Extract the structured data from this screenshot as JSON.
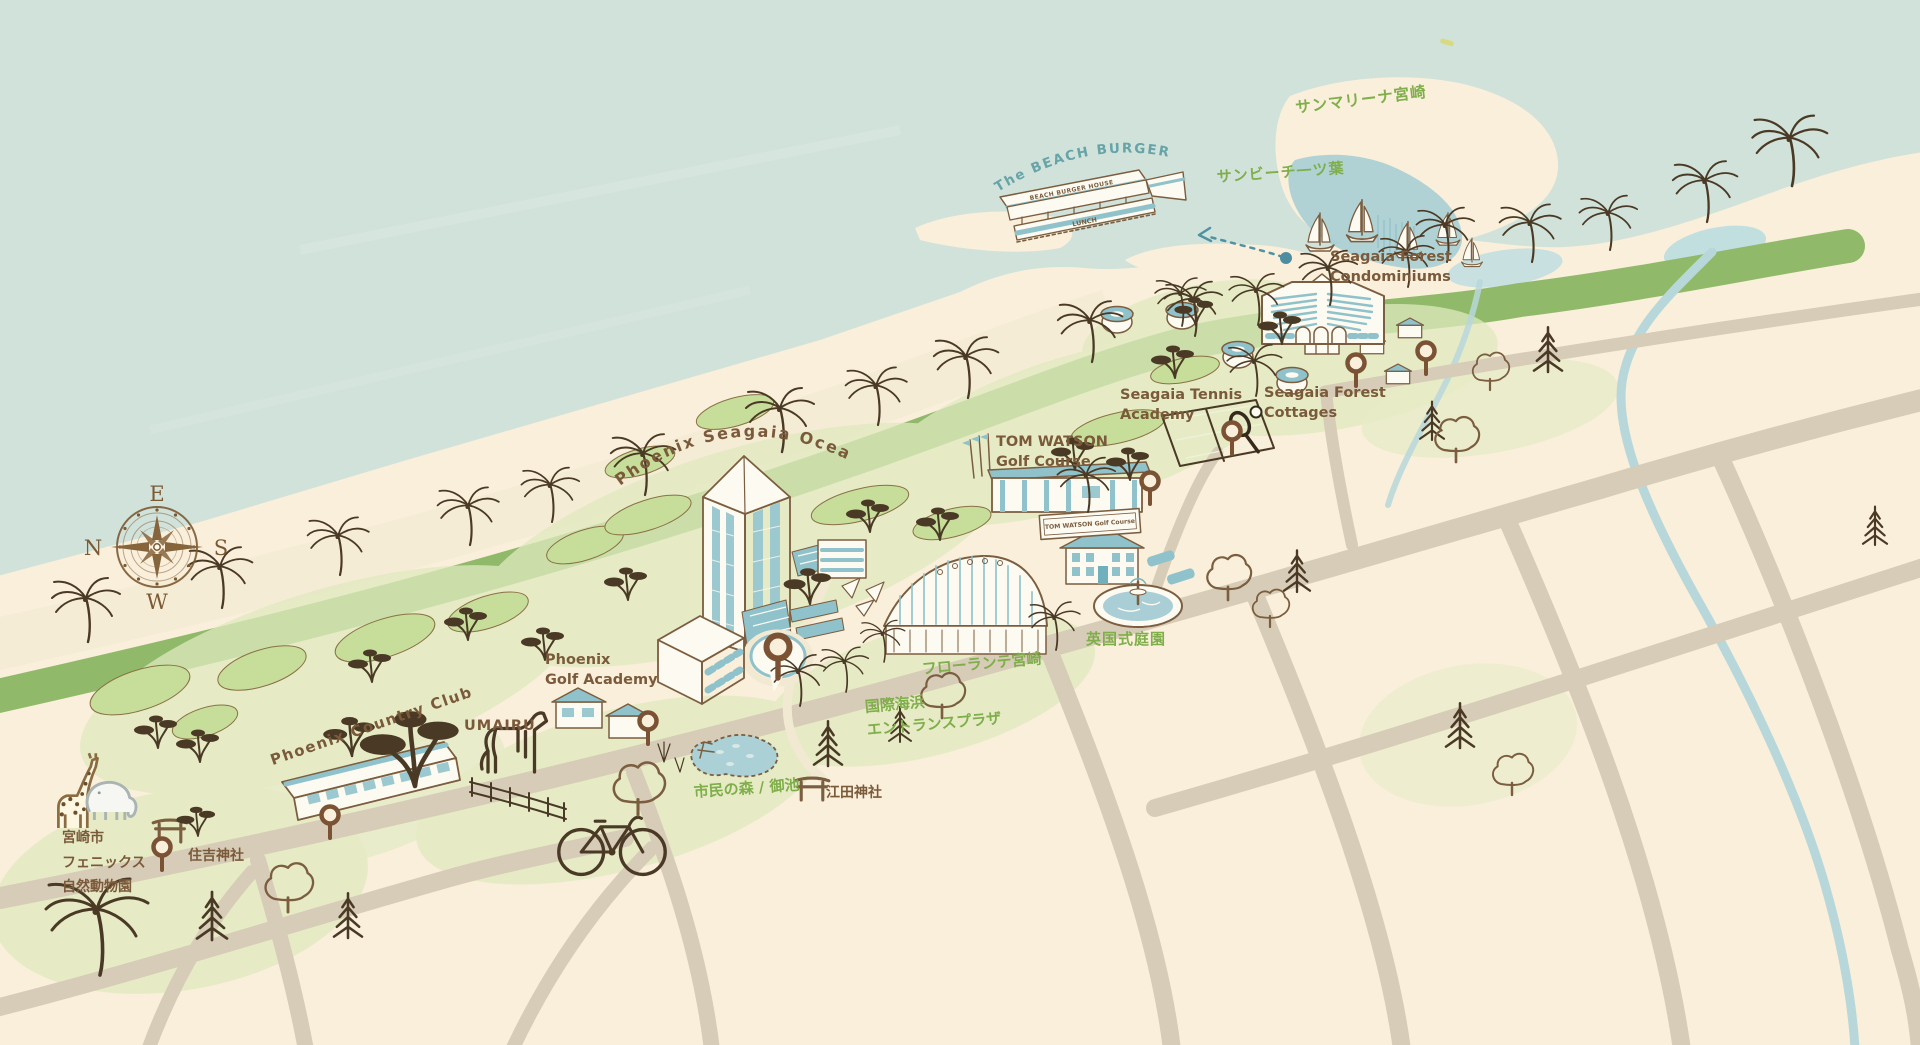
{
  "map": {
    "description": "Hand-drawn illustrated map of the Seagaia resort coastline",
    "compass": {
      "top": "E",
      "left": "N",
      "right": "S",
      "bottom": "W"
    },
    "colors": {
      "ocean": "#d1e2da",
      "land": "#f9efdb",
      "beach": "#f5ecd5",
      "greenbelt": "#90ba6a",
      "grass_light": "#dfeabf",
      "grass_green": "#c6de99",
      "road": "#d7ccb7",
      "river": "#b7d7da",
      "marina_water": "#a3ccd4",
      "teal": "#8fc2cb",
      "line_brown": "#7b5d3f",
      "dark_tree": "#4a3a25",
      "pin": "#7b5233",
      "brown": "#7a5a3a",
      "green": "#7fae4a",
      "tealtext": "#67a4a8"
    },
    "arc_labels": {
      "ocean_tower": "Phoenix Seagaia Ocean Tower",
      "burger_house": "The BEACH BURGER HOUSE"
    },
    "signs": {
      "burger_roof": "BEACH BURGER HOUSE",
      "burger_banner": "LUNCH",
      "tom_watson_sign": "TOM WATSON Golf Course"
    },
    "labels": [
      {
        "id": "sun-marina-miyazaki",
        "text": "サンマリーナ宮崎",
        "color": "green",
        "x": 1294,
        "y": 96,
        "rot": -7,
        "fs": 15.5,
        "ls": 1
      },
      {
        "id": "sun-beach-hitotsuba",
        "text": "サンビーチ一ツ葉",
        "color": "green",
        "x": 1216,
        "y": 166,
        "rot": -4,
        "fs": 15,
        "ls": 1
      },
      {
        "id": "seagaia-forest-condominiums",
        "text": "Seagaia Forest\nCondominiums",
        "color": "brown",
        "x": 1330,
        "y": 248,
        "fs": 14.5,
        "lh": 1.35
      },
      {
        "id": "seagaia-tennis-academy",
        "text": "Seagaia Tennis\nAcademy",
        "color": "brown",
        "x": 1120,
        "y": 386,
        "fs": 14.5,
        "lh": 1.35
      },
      {
        "id": "seagaia-forest-cottages",
        "text": "Seagaia Forest\nCottages",
        "color": "brown",
        "x": 1264,
        "y": 384,
        "fs": 14.5,
        "lh": 1.35
      },
      {
        "id": "tom-watson-golf-course",
        "text": "TOM WATSON\nGolf Course",
        "color": "brown",
        "x": 996,
        "y": 433,
        "fs": 14.5,
        "lh": 1.35
      },
      {
        "id": "phoenix-golf-academy",
        "text": "Phoenix\nGolf Academy",
        "color": "brown",
        "x": 545,
        "y": 651,
        "fs": 14.5,
        "lh": 1.35
      },
      {
        "id": "umairu",
        "text": "UMAIRU",
        "color": "brown",
        "x": 464,
        "y": 718,
        "fs": 14.5,
        "ls": 1
      },
      {
        "id": "phoenix-country-club",
        "text": "Phoenix Country Club",
        "color": "brown",
        "x": 268,
        "y": 752,
        "rot": -19,
        "fs": 15,
        "ls": 1.5
      },
      {
        "id": "miyazaki-phoenix-zoo",
        "text": "宮崎市\nフェニックス\n自然動物園",
        "color": "brown",
        "x": 62,
        "y": 826,
        "fs": 14,
        "lh": 1.75
      },
      {
        "id": "sumiyoshi-shrine",
        "text": "住吉神社",
        "color": "brown",
        "x": 188,
        "y": 845,
        "fs": 14
      },
      {
        "id": "shimin-no-mori-miike",
        "text": "市民の森 / 御池",
        "color": "green",
        "x": 693,
        "y": 781,
        "rot": -4,
        "fs": 15
      },
      {
        "id": "eda-shrine",
        "text": "江田神社",
        "color": "brown",
        "x": 826,
        "y": 782,
        "fs": 14
      },
      {
        "id": "florante-miyazaki",
        "text": "フローランテ宮崎",
        "color": "green",
        "x": 921,
        "y": 658,
        "rot": -5,
        "fs": 15
      },
      {
        "id": "english-garden",
        "text": "英国式庭園",
        "color": "green",
        "x": 1086,
        "y": 628,
        "fs": 15,
        "ls": 1
      },
      {
        "id": "kokusai-kaihin-entrance-plaza",
        "text": "国際海浜\nエントランスプラザ",
        "color": "green",
        "x": 864,
        "y": 696,
        "rot": -5,
        "fs": 15,
        "lh": 1.5
      }
    ]
  }
}
